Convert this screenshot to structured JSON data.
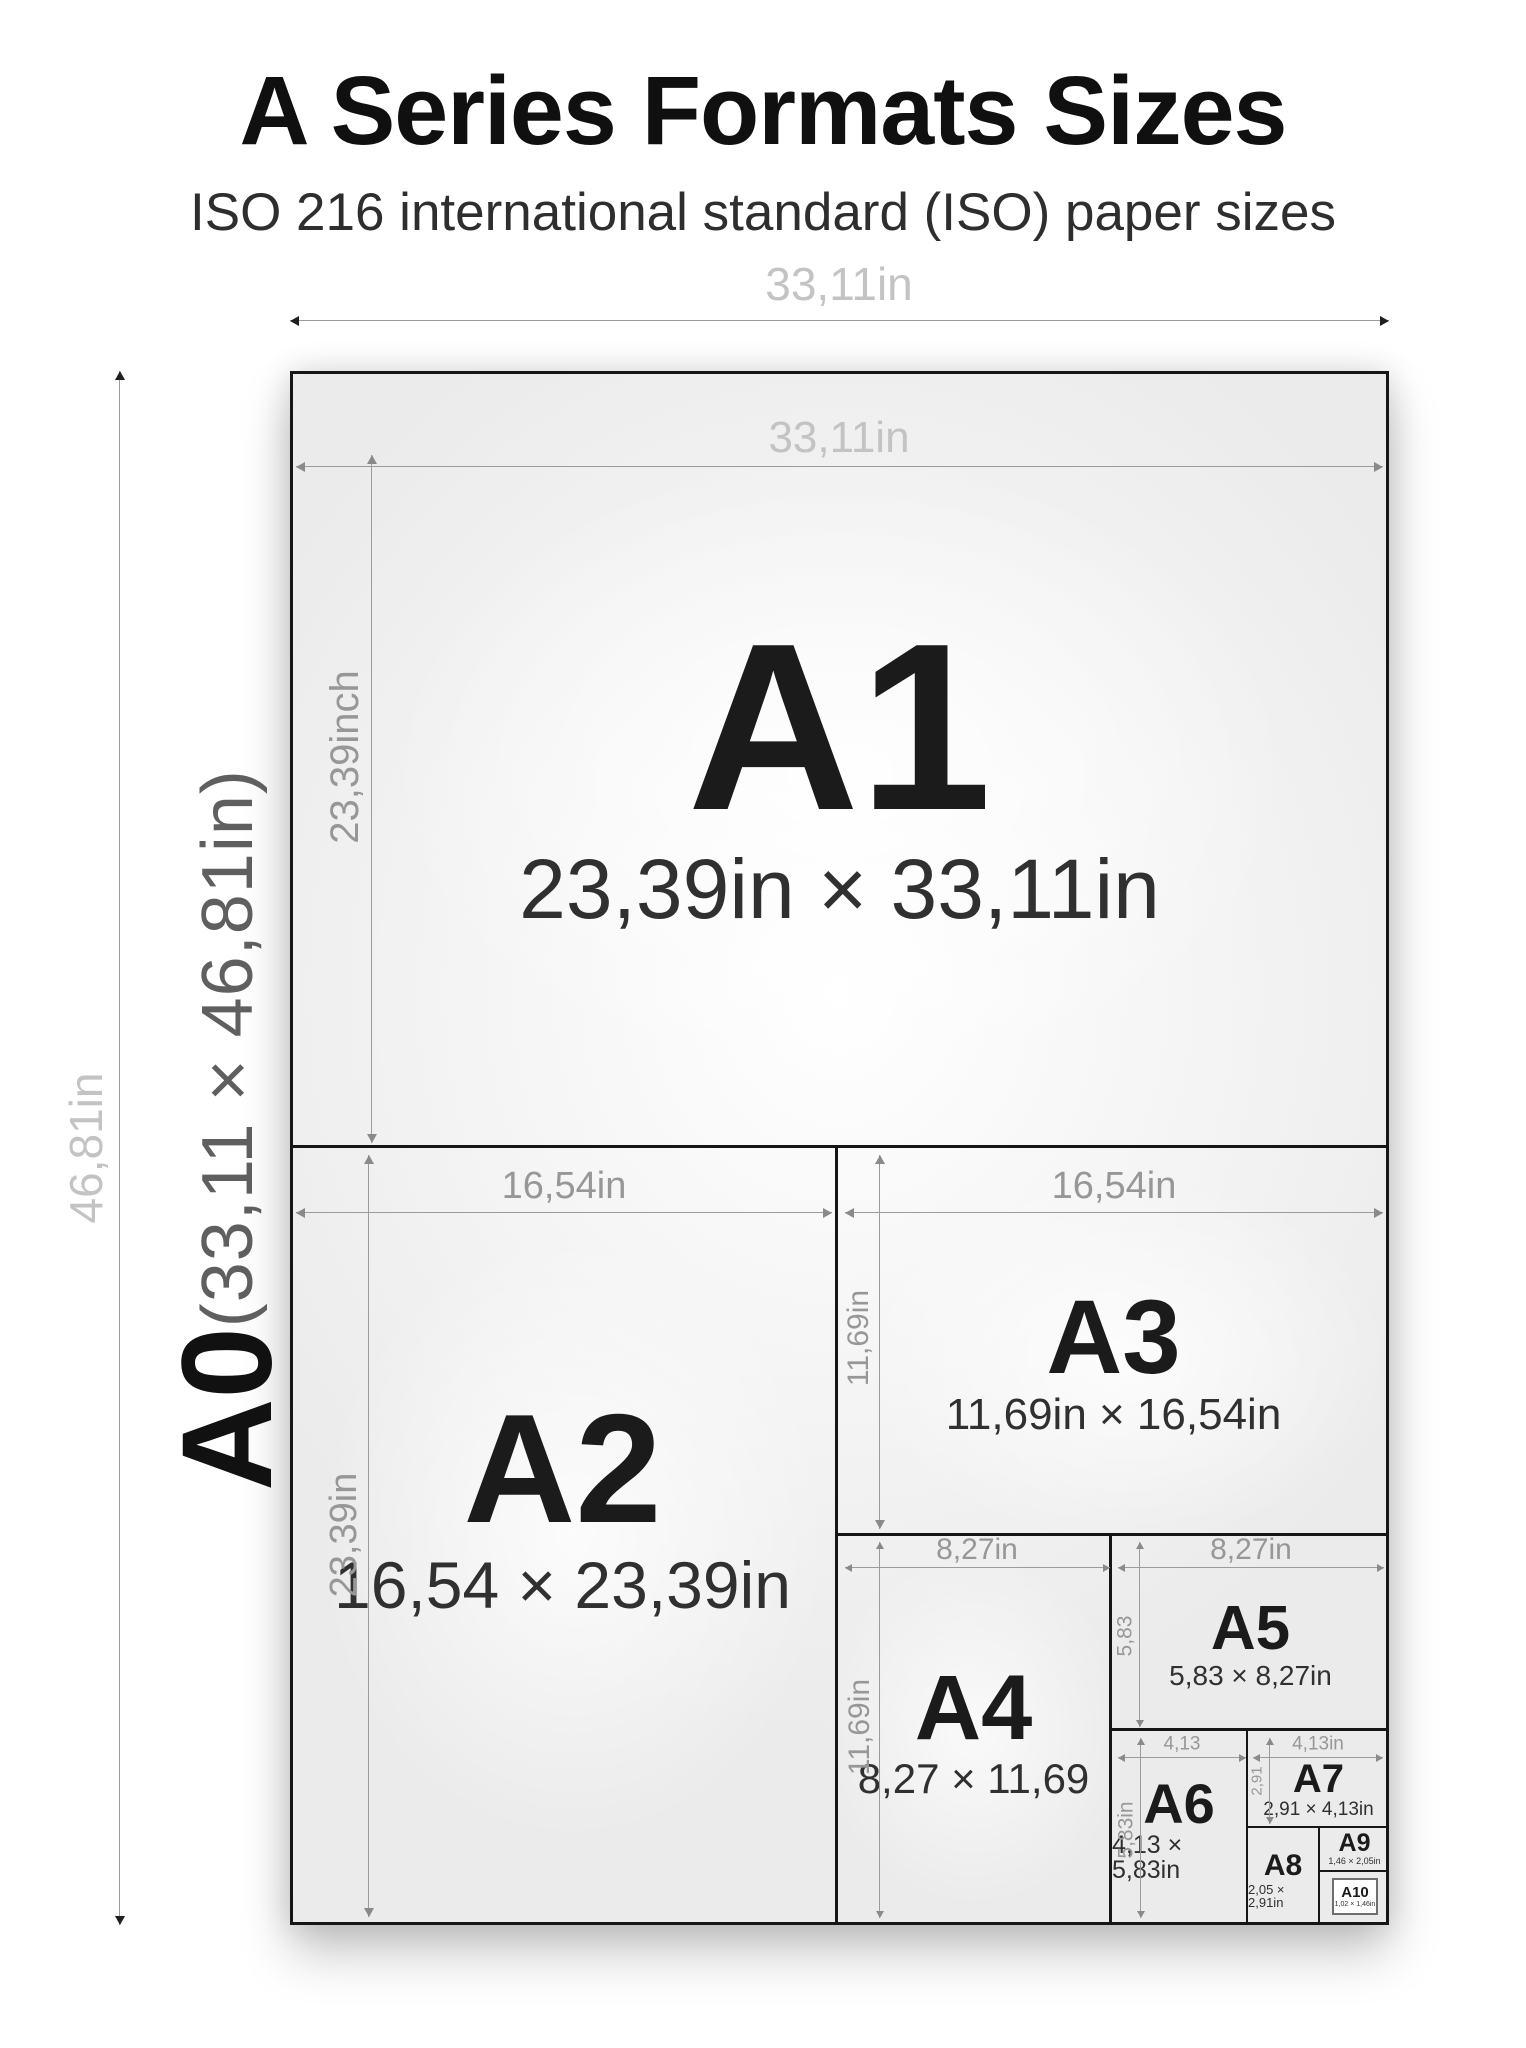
{
  "header": {
    "title_bold": "A",
    "title_rest": "Series Formats Sizes",
    "subtitle": "ISO 216 international standard (ISO) paper sizes"
  },
  "a0": {
    "name": "A0",
    "dims": "(33,11 × 46,81in)",
    "width_dim": "33,11in",
    "height_dim": "46,81in"
  },
  "formats": {
    "a1": {
      "name": "A1",
      "size": "23,39in × 33,11in",
      "width_dim": "33,11in",
      "height_dim": "23,39inch"
    },
    "a2": {
      "name": "A2",
      "size": "16,54 × 23,39in",
      "width_dim": "16,54in",
      "height_dim": "23,39in"
    },
    "a3": {
      "name": "A3",
      "size": "11,69in × 16,54in",
      "width_dim": "16,54in",
      "height_dim": "11,69in"
    },
    "a4": {
      "name": "A4",
      "size": "8,27 × 11,69",
      "width_dim": "8,27in",
      "height_dim": "11,69in"
    },
    "a5": {
      "name": "A5",
      "size": "5,83 × 8,27in",
      "width_dim": "8,27in",
      "height_dim": "5,83"
    },
    "a6": {
      "name": "A6",
      "size": "4,13 × 5,83in",
      "width_dim": "4,13",
      "height_dim": "5,83in"
    },
    "a7": {
      "name": "A7",
      "size": "2,91 × 4,13in",
      "width_dim": "4,13in",
      "height_dim": "2,91"
    },
    "a8": {
      "name": "A8",
      "size": "2,05 × 2,91in"
    },
    "a9": {
      "name": "A9",
      "size": "1,46 × 2,05in"
    },
    "a10": {
      "name": "A10",
      "size": "1,02 × 1,46in"
    }
  },
  "colors": {
    "paper_border": "#161616",
    "paper_fill": "#efefef",
    "dim_line": "#9b9b9b",
    "dim_label": "#979797",
    "dim_label_light": "#c3c3c3",
    "text": "#1b1b1b"
  }
}
